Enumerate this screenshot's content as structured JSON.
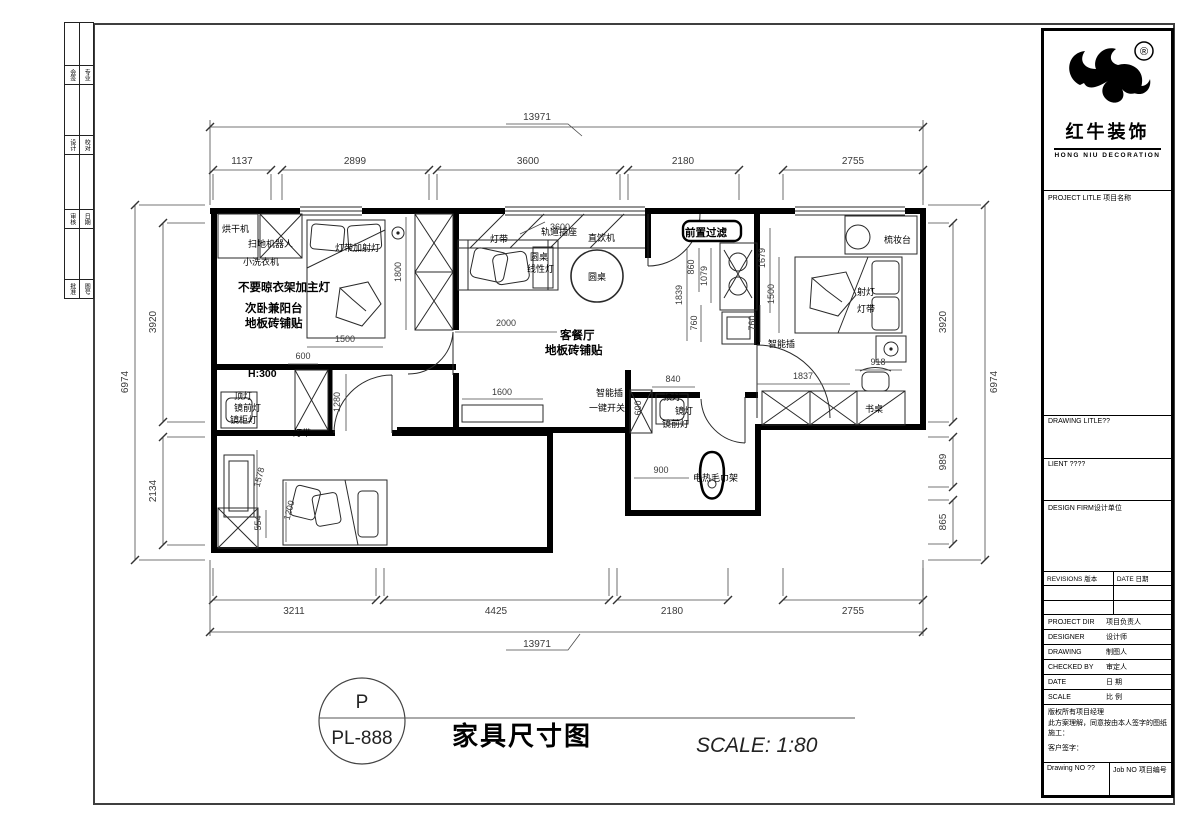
{
  "sheet": {
    "bg": "#ffffff",
    "line_color": "#000000",
    "dim_color": "#3a3a3a"
  },
  "signoff_strip": {
    "rows": [
      {
        "c1": "会签",
        "c2": "专业"
      },
      {
        "c1": "设计",
        "c2": "校对"
      },
      {
        "c1": "审核",
        "c2": "日期"
      },
      {
        "c1": "批准",
        "c2": "图号"
      }
    ]
  },
  "title_block": {
    "registered": "®",
    "brand_cn": "红牛装饰",
    "brand_en": "HONG NIU DECORATION",
    "project_label": "PROJECT LITLE 项目名称",
    "drawing_label": "DRAWING LITLE??",
    "client_label": "LIENT ????",
    "firm_label": "DESIGN FIRM设计单位",
    "revisions_label": "REVISIONS 版本",
    "date_label": "DATE 日期",
    "rows": [
      {
        "en": "PROJECT DIR",
        "cn": "项目负责人"
      },
      {
        "en": "DESIGNER",
        "cn": "设计师"
      },
      {
        "en": "DRAWING",
        "cn": "制图人"
      },
      {
        "en": "CHECKED BY",
        "cn": "审定人"
      },
      {
        "en": "DATE",
        "cn": "日 期"
      },
      {
        "en": "SCALE",
        "cn": "比 例"
      }
    ],
    "disclaimer1": "版权所有项目经理",
    "disclaimer2": "此方案理解，同意按由本人签字的图纸施工：",
    "disclaimer3": "客户签字：",
    "drawing_no": "Drawing NO ??",
    "job_no": "Job NO 项目编号"
  },
  "footer": {
    "bubble_top": "P",
    "bubble_bottom": "PL-888",
    "title": "家具尺寸图",
    "scale": "SCALE: 1:80"
  },
  "dims": {
    "top_total": "13971",
    "top": [
      "1137",
      "2899",
      "3600",
      "2180",
      "2755"
    ],
    "bottom": [
      "3211",
      "4425",
      "2180",
      "2755"
    ],
    "bottom_total": "13971",
    "left": [
      "3920",
      "2134"
    ],
    "left_total": "6974",
    "right": [
      "3920",
      "989",
      "865"
    ],
    "right_total": "6974",
    "bed1_w": "1500",
    "bed1_off": "600",
    "ward1_h": "1800",
    "sofa_w": "2000",
    "balcony_w": "3600",
    "tv_w": "1600",
    "hall_860": "860",
    "hall_1079": "1079",
    "hall_1839": "1839",
    "hall_760a": "760",
    "hall_760b": "760",
    "hall_1679": "1679",
    "hall_1500": "1500",
    "bath2_840": "840",
    "bath2_900": "900",
    "mbr_1837": "1837",
    "mbr_918": "918",
    "b3_1280": "1280",
    "b3_1578": "1578",
    "b3_1200": "1200",
    "b3_554": "554",
    "h300": "H:300",
    "cab_600": "600"
  },
  "labels": {
    "dryer": "烘干机",
    "robot": "扫地机器人",
    "washer": "小洗衣机",
    "strip_spot": "灯带加射灯",
    "no_rack": "不要晾衣架加主灯",
    "bedroom2_1": "次卧兼阳台",
    "bedroom2_2": "地板砖铺贴",
    "strip_a": "灯带",
    "track_socket": "轨道插座",
    "water": "直饮机",
    "table_s": "圆桌",
    "linear": "线性灯",
    "table_round": "圆桌",
    "living_1": "客餐厅",
    "living_2": "地板砖铺贴",
    "prefilter": "前置过滤",
    "vanity": "梳妆台",
    "spot": "射灯",
    "strip_b": "灯带",
    "smart_a": "智能插",
    "desk": "书桌",
    "smart_b": "智能插",
    "onekey": "一键开关",
    "ceil_a": "顶灯",
    "mirror_front_a": "镜前灯",
    "mirror_cab": "镜柜灯",
    "ceil_b": "顶灯",
    "mirror_b": "镜灯",
    "mirror_front_b": "镜前灯",
    "towel": "电热毛巾架",
    "strip_c": "灯带"
  }
}
